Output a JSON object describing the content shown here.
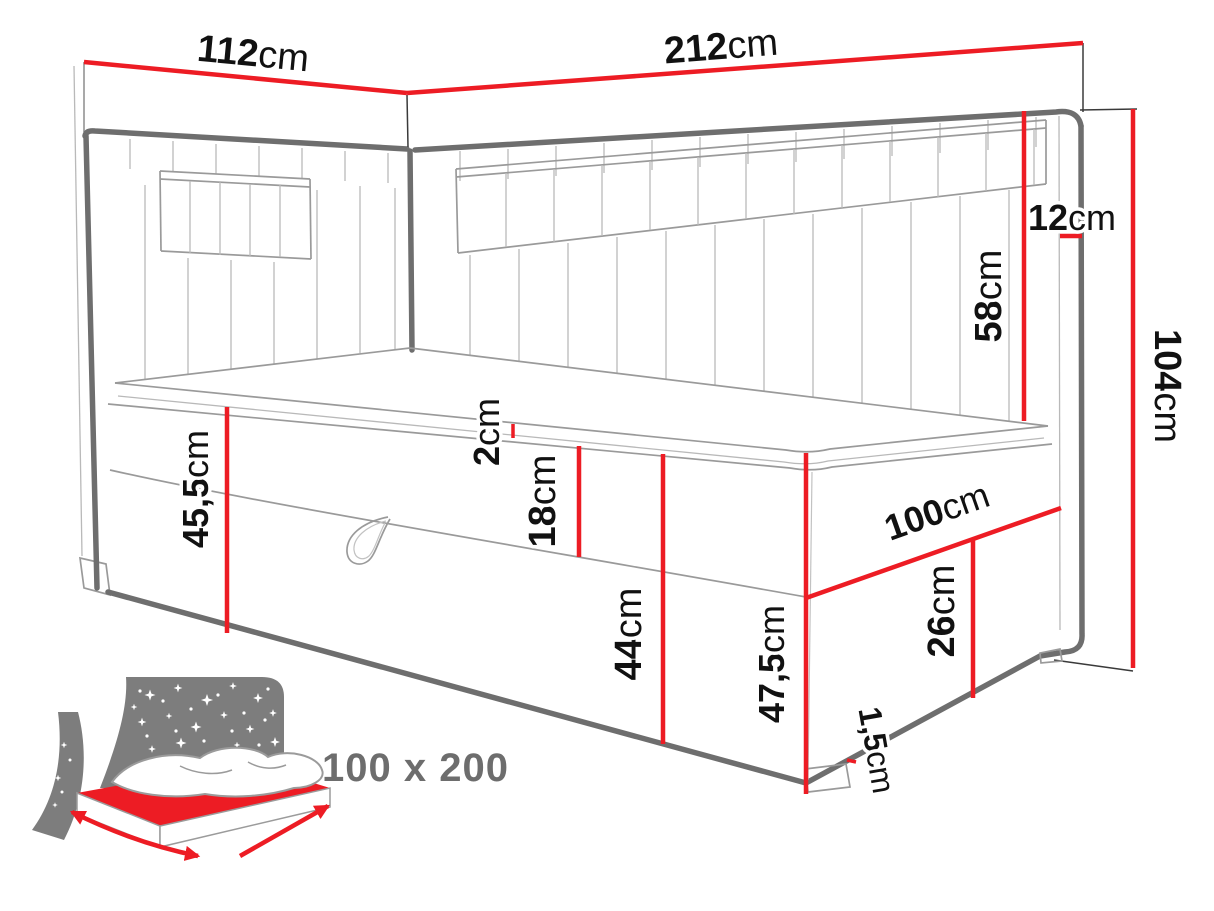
{
  "diagram": {
    "type": "corner-bed dimension drawing",
    "dimensions": {
      "side_width": {
        "num": "112",
        "unit": "cm"
      },
      "back_width": {
        "num": "212",
        "unit": "cm"
      },
      "panel_thickness": {
        "num": "12",
        "unit": "cm"
      },
      "headboard_height": {
        "num": "58",
        "unit": "cm"
      },
      "total_height": {
        "num": "104",
        "unit": "cm"
      },
      "topper_thickness": {
        "num": "2",
        "unit": "cm"
      },
      "frame_band_height": {
        "num": "18",
        "unit": "cm"
      },
      "base_height_head": {
        "num": "45,5",
        "unit": "cm"
      },
      "base_height_front": {
        "num": "44",
        "unit": "cm"
      },
      "side_height_foot": {
        "num": "47,5",
        "unit": "cm"
      },
      "bed_depth": {
        "num": "100",
        "unit": "cm"
      },
      "storage_height": {
        "num": "26",
        "unit": "cm"
      },
      "glide_height": {
        "num": "1,5",
        "unit": "cm"
      }
    },
    "badge": {
      "label": "100 x 200"
    },
    "colors": {
      "dimension_red": "#ed1c24",
      "outline_gray": "#6e6e6e",
      "icon_gray": "#7d7d7d",
      "label_black": "#111111",
      "badge_gray": "#6d6d6d",
      "background": "#ffffff"
    }
  }
}
